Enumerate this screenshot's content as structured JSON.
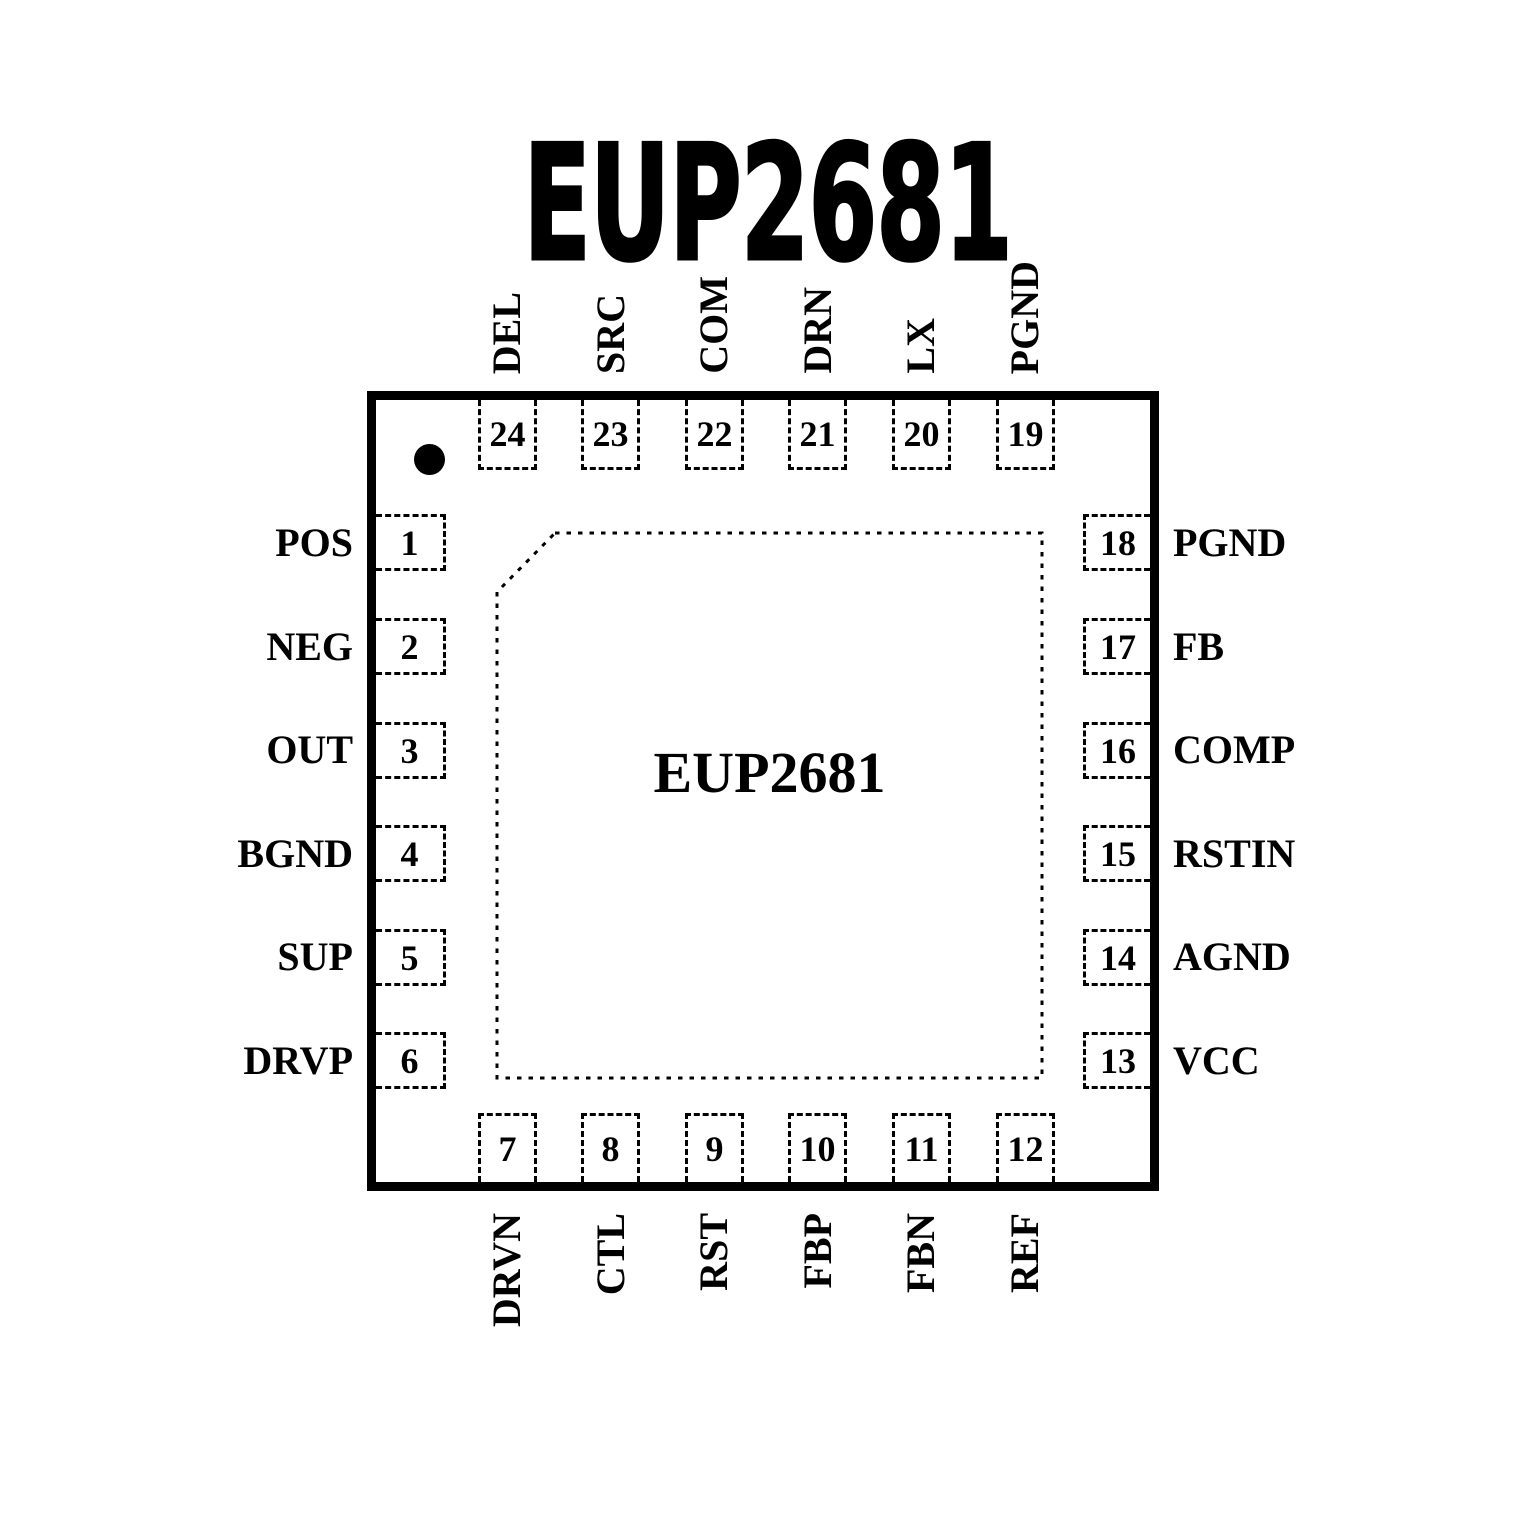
{
  "title": "EUP2681",
  "chip": {
    "name": "EUP2681"
  },
  "colors": {
    "ink": "#000000",
    "background": "#ffffff"
  },
  "package": {
    "type": "24-pin pinout diagram",
    "pin1_indicator": "filled-dot"
  },
  "pins": {
    "top": [
      {
        "number": "24",
        "name": "DEL"
      },
      {
        "number": "23",
        "name": "SRC"
      },
      {
        "number": "22",
        "name": "COM"
      },
      {
        "number": "21",
        "name": "DRN"
      },
      {
        "number": "20",
        "name": "LX"
      },
      {
        "number": "19",
        "name": "PGND"
      }
    ],
    "bottom": [
      {
        "number": "7",
        "name": "DRVN"
      },
      {
        "number": "8",
        "name": "CTL"
      },
      {
        "number": "9",
        "name": "RST"
      },
      {
        "number": "10",
        "name": "FBP"
      },
      {
        "number": "11",
        "name": "FBN"
      },
      {
        "number": "12",
        "name": "REF"
      }
    ],
    "left": [
      {
        "number": "1",
        "name": "POS"
      },
      {
        "number": "2",
        "name": "NEG"
      },
      {
        "number": "3",
        "name": "OUT"
      },
      {
        "number": "4",
        "name": "BGND"
      },
      {
        "number": "5",
        "name": "SUP"
      },
      {
        "number": "6",
        "name": "DRVP"
      }
    ],
    "right": [
      {
        "number": "18",
        "name": "PGND"
      },
      {
        "number": "17",
        "name": "FB"
      },
      {
        "number": "16",
        "name": "COMP"
      },
      {
        "number": "15",
        "name": "RSTIN"
      },
      {
        "number": "14",
        "name": "AGND"
      },
      {
        "number": "13",
        "name": "VCC"
      }
    ]
  }
}
